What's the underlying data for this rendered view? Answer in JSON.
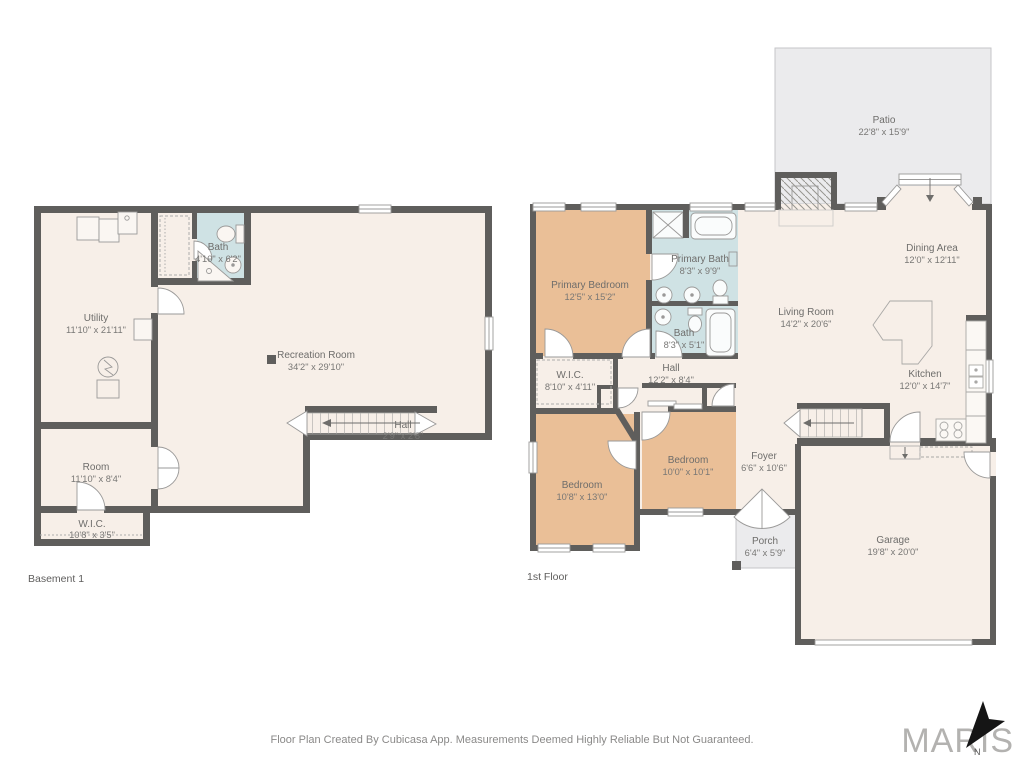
{
  "meta": {
    "footer": "Floor Plan Created By Cubicasa App. Measurements Deemed Highly Reliable But Not Guaranteed.",
    "brand": "MARIS",
    "compass_label": "N"
  },
  "colors": {
    "wall": "#5f5e5c",
    "floor_cream": "#f7efe8",
    "room_peach": "#eabf97",
    "room_blue": "#cfe2e4",
    "outdoor_gray": "#ebebed",
    "label_text": "#6e6d6b"
  },
  "floors": {
    "basement": {
      "label": "Basement 1",
      "rooms": {
        "utility": {
          "name": "Utility",
          "dims": "11'10\" x 21'11\""
        },
        "bath": {
          "name": "Bath",
          "dims": "4'10\" x 6'2\""
        },
        "recreation": {
          "name": "Recreation Room",
          "dims": "34'2\" x 29'10\""
        },
        "hall": {
          "name": "Hall",
          "dims": "2'9\" x 2'8\""
        },
        "room": {
          "name": "Room",
          "dims": "11'10\" x 8'4\""
        },
        "wic": {
          "name": "W.I.C.",
          "dims": "10'8\" x 3'5\""
        }
      }
    },
    "first": {
      "label": "1st Floor",
      "rooms": {
        "primary_bedroom": {
          "name": "Primary Bedroom",
          "dims": "12'5\" x 15'2\""
        },
        "primary_bath": {
          "name": "Primary Bath",
          "dims": "8'3\" x 9'9\""
        },
        "bath": {
          "name": "Bath",
          "dims": "8'3\" x 5'1\""
        },
        "hall": {
          "name": "Hall",
          "dims": "12'2\" x 8'4\""
        },
        "wic": {
          "name": "W.I.C.",
          "dims": "8'10\" x 4'11\""
        },
        "bedroom_small": {
          "name": "Bedroom",
          "dims": "10'0\" x 10'1\""
        },
        "bedroom_large": {
          "name": "Bedroom",
          "dims": "10'8\" x 13'0\""
        },
        "foyer": {
          "name": "Foyer",
          "dims": "6'6\" x 10'6\""
        },
        "porch": {
          "name": "Porch",
          "dims": "6'4\" x 5'9\""
        },
        "garage": {
          "name": "Garage",
          "dims": "19'8\" x 20'0\""
        },
        "living": {
          "name": "Living Room",
          "dims": "14'2\" x 20'6\""
        },
        "dining": {
          "name": "Dining Area",
          "dims": "12'0\" x 12'11\""
        },
        "kitchen": {
          "name": "Kitchen",
          "dims": "12'0\" x 14'7\""
        },
        "patio": {
          "name": "Patio",
          "dims": "22'8\" x 15'9\""
        }
      }
    }
  }
}
